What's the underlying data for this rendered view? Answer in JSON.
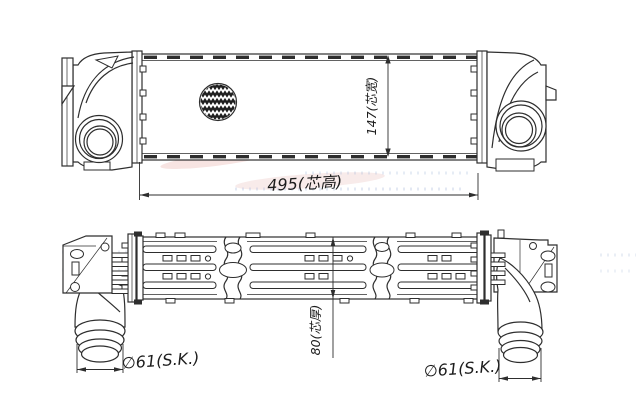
{
  "drawing": {
    "type": "technical-line-drawing",
    "subject": "intercooler two-view dimensioned drawing"
  },
  "labels": {
    "core_length": "495(芯高)",
    "overall_width": "147(芯宽)",
    "core_thickness": "80(芯厚)",
    "pipe_diameter_left": "∅61(S.K.)",
    "pipe_diameter_right": "∅61(S.K.)"
  },
  "dimensions": {
    "core_length_mm": 495,
    "overall_width_mm": 147,
    "core_thickness_mm": 80,
    "pipe_outer_diameter_mm": 61
  },
  "colors": {
    "background": "#ffffff",
    "line": "#2e2e2e",
    "watermark_pink": "#dd928b",
    "watermark_blue": "#8fa7cf"
  }
}
